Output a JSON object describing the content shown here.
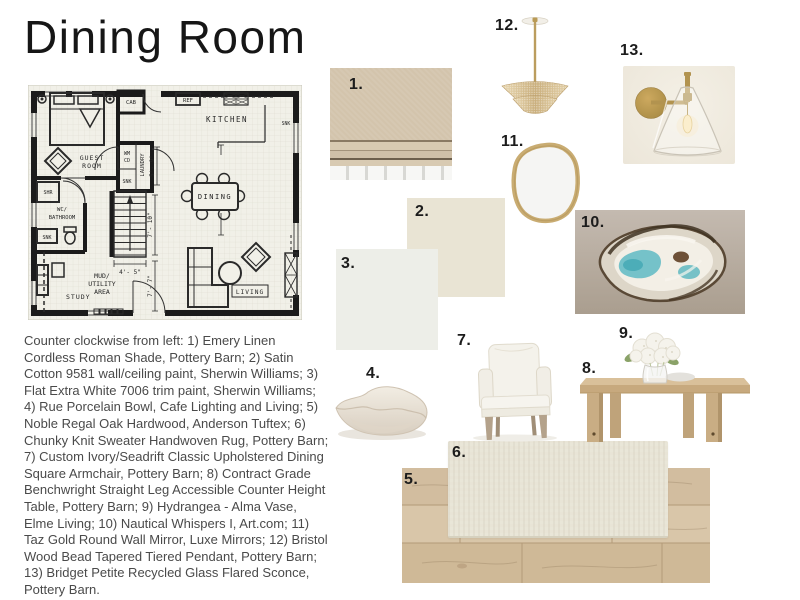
{
  "title": "Dining Room",
  "description": "Counter clockwise from left: 1) Emery Linen Cordless Roman Shade, Pottery Barn; 2) Satin Cotton 9581 wall/ceiling paint, Sherwin Williams; 3) Flat Extra White 7006 trim paint, Sherwin Williams; 4) Rue Porcelain Bowl, Cafe Lighting and Living; 5) Noble Regal Oak Hardwood, Anderson Tuftex; 6) Chunky Knit Sweater Handwoven Rug, Pottery Barn; 7) Custom Ivory/Seadrift Classic Upholstered Dining Square Armchair, Pottery Barn; 8) Contract Grade Benchwright Straight Leg Accessible Counter Height Table, Pottery Barn; 9) Hydrangea - Alma Vase, Elme Living; 10) Nautical Whispers I, Art.com; 11) Taz Gold Round Wall Mirror, Luxe Mirrors; 12) Bristol Wood Bead Tapered Tiered Pendant, Pottery Barn; 13) Bridget Petite Recycled Glass Flared Sconce, Pottery Barn.",
  "items": [
    {
      "number": "1.",
      "name": "Emery Linen Cordless Roman Shade, Pottery Barn"
    },
    {
      "number": "2.",
      "name": "Satin Cotton 9581 wall/ceiling paint, Sherwin Williams"
    },
    {
      "number": "3.",
      "name": "Flat Extra White 7006 trim paint, Sherwin Williams"
    },
    {
      "number": "4.",
      "name": "Rue Porcelain Bowl, Cafe Lighting and Living"
    },
    {
      "number": "5.",
      "name": "Noble Regal Oak Hardwood, Anderson Tuftex"
    },
    {
      "number": "6.",
      "name": "Chunky Knit Sweater Handwoven Rug, Pottery Barn"
    },
    {
      "number": "7.",
      "name": "Custom Ivory/Seadrift Classic Upholstered Dining Square Armchair, Pottery Barn"
    },
    {
      "number": "8.",
      "name": "Contract Grade Benchwright Straight Leg Accessible Counter Height Table, Pottery Barn"
    },
    {
      "number": "9.",
      "name": "Hydrangea - Alma Vase, Elme Living"
    },
    {
      "number": "10.",
      "name": "Nautical Whispers I, Art.com"
    },
    {
      "number": "11.",
      "name": "Taz Gold Round Wall Mirror, Luxe Mirrors"
    },
    {
      "number": "12.",
      "name": "Bristol Wood Bead Tapered Tiered Pendant, Pottery Barn"
    },
    {
      "number": "13.",
      "name": "Bridget Petite Recycled Glass Flared Sconce, Pottery Barn"
    }
  ],
  "floor_plan": {
    "labels": {
      "guest1": "GUEST",
      "guest2": "ROOM",
      "kitchen": "KITCHEN",
      "dining": "DINING",
      "living": "LIVING",
      "study": "STUDY",
      "wc1": "WC/",
      "wc2": "BATHROOM",
      "mud1": "MUD/",
      "mud2": "UTILITY",
      "mud3": "AREA",
      "laundry": "LAUNDRY",
      "cab": "CAB",
      "ref": "REF",
      "shr": "SHR",
      "snk": "SNK",
      "wm": "WM",
      "cd": "CD"
    },
    "dimensions": {
      "stairs": "4'- 5\"",
      "hall": "7'- 10\"",
      "upper": "5'- 9\"",
      "lower": "7'- 7\""
    }
  },
  "colors": {
    "paint_satin_cotton": "#e9e4d4",
    "paint_flat_extra_white": "#edeee8",
    "shade_linen": "#d3c4ac",
    "brass": "#b2934f",
    "oak": "#c9ad84",
    "rug": "#e8e4d6",
    "teal_accent": "#5cb6bf"
  }
}
